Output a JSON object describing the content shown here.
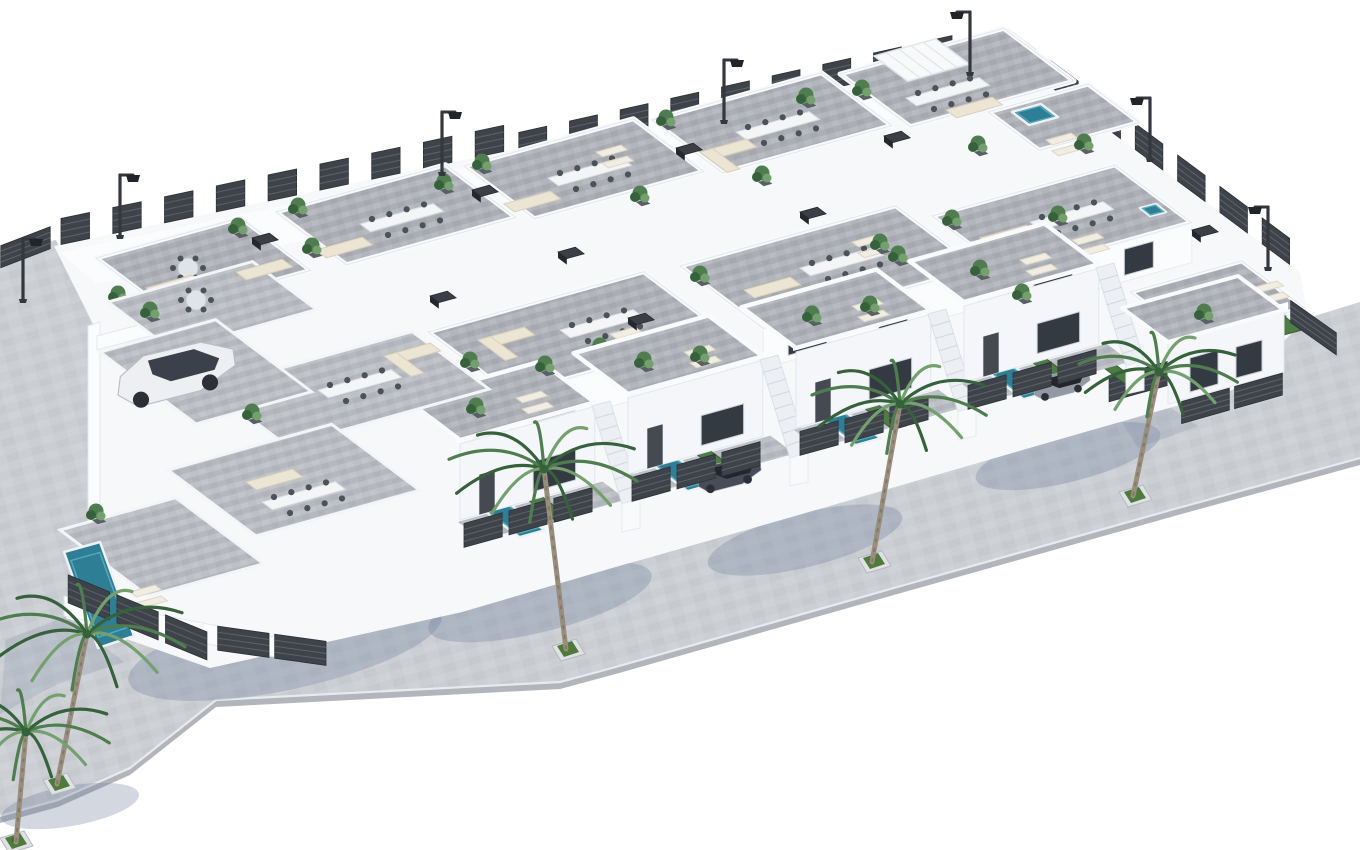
{
  "meta": {
    "title": "New-build villa development - aerial 3D architectural render",
    "description": "Isometric aerial 3D rendering of a gated complex of white modern villas with grey stone roof terraces furnished with outdoor sofas, dining tables and sun loungers, private turquoise plunge pools, dark slatted privacy fencing, perimeter street lamps, parked cars, and a light grey sidewalk lined with palm trees in square planters, on a plain white background.",
    "style": "3D architectural visualization, dimetric aerial view",
    "background": "#ffffff",
    "counts": {
      "villas": 16,
      "roof_terraces": 11,
      "pools": 8,
      "palm_trees": 5,
      "street_lamps": 7,
      "cars": 3,
      "fence_runs": 10
    }
  },
  "palette": {
    "street": "#cbced3",
    "streetFace": "#b2b5bb",
    "curb": "#e8eaed",
    "tile": "#aeb1b7",
    "yard": "#b8bbc1",
    "white": "#fbfcfe",
    "whiteShade": "#eef1f6",
    "whiteDark": "#dde3ea",
    "fence": "#3e434a",
    "fenceLine": "#5a6068",
    "pool": "#2e7e95",
    "poolLight": "#57aabf",
    "green": "#4e7c46",
    "greenDark": "#3a5e33",
    "palm": "#4f7d4f",
    "palmDark": "#35613b",
    "palmLight": "#74a06e",
    "trunk": "#998d7e",
    "cream": "#ece5d4",
    "creamEdge": "#d9d0bb",
    "glass": "#343a42",
    "darkBox": "#3c4046",
    "shadow": "rgba(115,130,160,0.32)",
    "wallShadow": "rgba(125,140,168,0.22)",
    "carWhite": "#edeff3",
    "carDark": "#474d58",
    "carGray": "#9299a3"
  },
  "street": {
    "outline": [
      [
        0,
        250
      ],
      [
        56,
        240
      ],
      [
        97,
        332
      ],
      [
        97,
        552
      ],
      [
        66,
        618
      ],
      [
        210,
        668
      ],
      [
        300,
        648
      ],
      [
        462,
        612
      ],
      [
        612,
        568
      ],
      [
        788,
        518
      ],
      [
        936,
        475
      ],
      [
        1085,
        432
      ],
      [
        1232,
        390
      ],
      [
        1308,
        318
      ],
      [
        1360,
        302
      ],
      [
        1360,
        458
      ],
      [
        1178,
        508
      ],
      [
        908,
        584
      ],
      [
        612,
        668
      ],
      [
        560,
        682
      ],
      [
        216,
        700
      ],
      [
        130,
        768
      ],
      [
        58,
        800
      ],
      [
        0,
        816
      ]
    ],
    "outer": [
      [
        0,
        816
      ],
      [
        58,
        800
      ],
      [
        130,
        768
      ],
      [
        216,
        700
      ],
      [
        560,
        682
      ],
      [
        612,
        668
      ],
      [
        908,
        584
      ],
      [
        1178,
        508
      ],
      [
        1360,
        458
      ]
    ],
    "planters": [
      [
        57,
        782
      ],
      [
        566,
        648
      ],
      [
        872,
        560
      ],
      [
        1133,
        494
      ],
      [
        14,
        840
      ]
    ]
  },
  "parcel": [
    [
      54,
      246
    ],
    [
      520,
      148
    ],
    [
      512,
      160
    ],
    [
      968,
      58
    ],
    [
      1004,
      52
    ],
    [
      1300,
      272
    ],
    [
      1308,
      318
    ],
    [
      1232,
      390
    ],
    [
      1085,
      432
    ],
    [
      936,
      475
    ],
    [
      788,
      518
    ],
    [
      612,
      568
    ],
    [
      462,
      612
    ],
    [
      300,
      648
    ],
    [
      210,
      668
    ],
    [
      66,
      618
    ],
    [
      97,
      552
    ],
    [
      97,
      332
    ]
  ],
  "shadows": {
    "palms": [
      {
        "cx": 285,
        "cy": 648,
        "rx": 160,
        "ry": 42,
        "rot": -12
      },
      {
        "cx": 540,
        "cy": 602,
        "rx": 115,
        "ry": 30,
        "rot": -14
      },
      {
        "cx": 805,
        "cy": 540,
        "rx": 100,
        "ry": 27,
        "rot": -14
      },
      {
        "cx": 1068,
        "cy": 456,
        "rx": 95,
        "ry": 26,
        "rot": -14
      },
      {
        "cx": 70,
        "cy": 806,
        "rx": 70,
        "ry": 20,
        "rot": -10
      }
    ],
    "walls": [
      [
        [
          66,
          616
        ],
        [
          6,
          640
        ],
        [
          0,
          714
        ],
        [
          58,
          684
        ],
        [
          124,
          662
        ]
      ],
      [
        [
          458,
          524
        ],
        [
          410,
          540
        ],
        [
          426,
          566
        ],
        [
          478,
          548
        ]
      ],
      [
        [
          626,
          478
        ],
        [
          578,
          494
        ],
        [
          594,
          520
        ],
        [
          646,
          502
        ]
      ],
      [
        [
          794,
          432
        ],
        [
          746,
          448
        ],
        [
          762,
          474
        ],
        [
          814,
          456
        ]
      ],
      [
        [
          962,
          386
        ],
        [
          914,
          402
        ],
        [
          930,
          428
        ],
        [
          982,
          410
        ]
      ],
      [
        [
          1168,
          406
        ],
        [
          1122,
          422
        ],
        [
          1138,
          448
        ],
        [
          1198,
          426
        ]
      ]
    ]
  },
  "fences": [
    [
      54,
      246,
      520,
      148,
      26
    ],
    [
      512,
      160,
      968,
      58,
      26
    ],
    [
      1004,
      52,
      1300,
      272,
      26
    ],
    [
      0,
      268,
      52,
      248,
      22
    ],
    [
      1108,
      402,
      1180,
      382,
      24
    ]
  ],
  "back_terraces": [
    {
      "x": 96,
      "y": 258,
      "w": 150,
      "d": 88,
      "furn": [
        [
          "round",
          188,
          268
        ],
        [
          "sofa",
          146,
          288
        ],
        [
          "plant",
          118,
          302
        ],
        [
          "plant",
          238,
          234
        ]
      ]
    },
    {
      "x": 276,
      "y": 212,
      "w": 176,
      "d": 88,
      "furn": [
        [
          "table",
          360,
          224
        ],
        [
          "sofa",
          316,
          250
        ],
        [
          "plant",
          298,
          214
        ],
        [
          "plant",
          444,
          190
        ]
      ]
    },
    {
      "x": 464,
      "y": 166,
      "w": 176,
      "d": 88,
      "furn": [
        [
          "table",
          548,
          178
        ],
        [
          "sofa",
          504,
          204
        ],
        [
          "lounge",
          596,
          152
        ],
        [
          "plant",
          482,
          170
        ]
      ]
    },
    {
      "x": 652,
      "y": 120,
      "w": 176,
      "d": 88,
      "furn": [
        [
          "table",
          736,
          132
        ],
        [
          "sofaL",
          700,
          152
        ],
        [
          "plant",
          666,
          126
        ],
        [
          "plant",
          806,
          104
        ]
      ]
    },
    {
      "x": 840,
      "y": 74,
      "w": 170,
      "d": 88,
      "furn": [
        [
          "pergola",
          874,
          56
        ],
        [
          "table",
          906,
          98
        ],
        [
          "sofa",
          946,
          110
        ],
        [
          "plant",
          862,
          96
        ]
      ]
    },
    {
      "x": 988,
      "y": 112,
      "w": 104,
      "d": 64,
      "furn": [
        [
          "lounge",
          1046,
          140
        ],
        [
          "plant",
          1084,
          150
        ]
      ]
    }
  ],
  "mid_terraces": [
    {
      "x": 428,
      "y": 332,
      "w": 224,
      "d": 104,
      "facade": 1,
      "furn": [
        [
          "table",
          560,
          330
        ],
        [
          "sofaL",
          478,
          340
        ],
        [
          "lounge",
          610,
          334
        ],
        [
          "plant",
          600,
          354
        ],
        [
          "plant",
          470,
          368
        ]
      ]
    },
    {
      "x": 680,
      "y": 266,
      "w": 224,
      "d": 104,
      "facade": 1,
      "furn": [
        [
          "table",
          800,
          268
        ],
        [
          "sofa",
          744,
          290
        ],
        [
          "lounge",
          852,
          242
        ],
        [
          "plant",
          700,
          282
        ],
        [
          "plant",
          880,
          250
        ]
      ]
    },
    {
      "x": 932,
      "y": 216,
      "w": 190,
      "d": 96,
      "facade": 1,
      "furn": [
        [
          "table",
          1030,
          222
        ],
        [
          "sofaL",
          980,
          238
        ],
        [
          "plant",
          952,
          226
        ],
        [
          "lounge",
          1072,
          240
        ]
      ]
    },
    {
      "x": 1130,
      "y": 292,
      "w": 116,
      "d": 78,
      "furn": [
        [
          "sofa",
          1180,
          300
        ],
        [
          "round",
          1226,
          306
        ],
        [
          "plant",
          1160,
          316
        ],
        [
          "lounge",
          1252,
          288
        ]
      ]
    }
  ],
  "front_houses": [
    {
      "x": 460,
      "y": 520
    },
    {
      "x": 628,
      "y": 474,
      "car": "dark"
    },
    {
      "x": 796,
      "y": 428
    },
    {
      "x": 964,
      "y": 382,
      "car": "gray"
    }
  ],
  "left_block": {
    "walls": [
      [
        [
          88,
          326
        ],
        [
          100,
          322
        ],
        [
          100,
          568
        ],
        [
          88,
          574
        ]
      ],
      [
        [
          97,
          336
        ],
        [
          282,
          287
        ],
        [
          282,
          301
        ],
        [
          97,
          350
        ]
      ],
      [
        [
          64,
          596
        ],
        [
          300,
          642
        ],
        [
          300,
          662
        ],
        [
          64,
          616
        ]
      ]
    ],
    "tiles": [
      [
        108,
        302,
        150,
        80
      ],
      [
        210,
        388,
        210,
        96
      ],
      [
        168,
        470,
        170,
        110
      ],
      [
        100,
        352,
        120,
        120
      ],
      [
        60,
        530,
        120,
        110
      ]
    ],
    "pool": [
      [
        64,
        552
      ],
      [
        100,
        542
      ],
      [
        134,
        636
      ],
      [
        98,
        648
      ]
    ],
    "furniture": [
      [
        "round",
        196,
        300
      ],
      [
        "sofa",
        236,
        272
      ],
      [
        "plant",
        150,
        318
      ],
      [
        "table",
        318,
        390
      ],
      [
        "plant",
        252,
        420
      ],
      [
        "sofaL",
        384,
        356
      ],
      [
        "sofa",
        246,
        482
      ],
      [
        "table",
        262,
        502
      ],
      [
        "lounge",
        130,
        592
      ],
      [
        "plant",
        96,
        520
      ]
    ],
    "fences": [
      [
        66,
        602,
        212,
        662,
        28
      ],
      [
        216,
        650,
        330,
        666,
        24
      ]
    ],
    "car": {
      "x": 118,
      "y": 402,
      "type": "suv"
    }
  },
  "corner_house": {
    "facade": [
      [
        1168,
        404
      ],
      [
        1284,
        372
      ],
      [
        1284,
        310
      ],
      [
        1168,
        342
      ]
    ],
    "slab": [
      [
        1164,
        344
      ],
      [
        1288,
        310
      ],
      [
        1288,
        302
      ],
      [
        1164,
        336
      ]
    ],
    "roof": [
      [
        1168,
        342
      ],
      [
        1284,
        310
      ],
      [
        1238,
        276
      ],
      [
        1122,
        308
      ]
    ],
    "windows": [
      [
        [
          1190,
          392
        ],
        [
          1218,
          384
        ],
        [
          1218,
          350
        ],
        [
          1190,
          358
        ]
      ],
      [
        [
          1236,
          378
        ],
        [
          1262,
          371
        ],
        [
          1262,
          340
        ],
        [
          1236,
          347
        ]
      ]
    ],
    "pool": [
      [
        1236,
        300
      ],
      [
        1259,
        294
      ],
      [
        1290,
        317
      ],
      [
        1267,
        323
      ]
    ],
    "hedge": [
      [
        1262,
        322
      ],
      [
        1284,
        316
      ],
      [
        1302,
        330
      ],
      [
        1280,
        336
      ]
    ],
    "fences": [
      [
        1290,
        322,
        1338,
        356,
        22
      ],
      [
        1180,
        424,
        1286,
        394,
        22
      ]
    ]
  },
  "pools_extra": [
    {
      "pts": [
        [
          1012,
          112
        ],
        [
          1041,
          104
        ],
        [
          1058,
          117
        ],
        [
          1029,
          125
        ]
      ],
      "name": "rooftop-pool"
    },
    {
      "pts": [
        [
          1140,
          208
        ],
        [
          1156,
          204
        ],
        [
          1166,
          212
        ],
        [
          1150,
          216
        ]
      ],
      "name": "spa-pool"
    }
  ],
  "hedges_extra": [
    {
      "x": 1096,
      "y": 362,
      "w": 12,
      "d": 36
    }
  ],
  "plants_extra": [
    [
      312,
      254
    ],
    [
      640,
      202
    ],
    [
      762,
      182
    ],
    [
      978,
      152
    ],
    [
      1058,
      222
    ],
    [
      898,
      262
    ],
    [
      1204,
      320
    ],
    [
      700,
      362
    ],
    [
      870,
      312
    ],
    [
      1022,
      300
    ],
    [
      545,
      372
    ]
  ],
  "ac_units": [
    [
      800,
      212
    ],
    [
      884,
      136
    ],
    [
      558,
      252
    ],
    [
      430,
      296
    ],
    [
      252,
      238
    ],
    [
      1192,
      230
    ],
    [
      676,
      148
    ],
    [
      472,
      190
    ],
    [
      628,
      318
    ]
  ],
  "palms": [
    {
      "x": 57,
      "y": 784,
      "h": 150,
      "lean": 30,
      "s": 100
    },
    {
      "x": 566,
      "y": 649,
      "h": 180,
      "lean": -22,
      "s": 95
    },
    {
      "x": 872,
      "y": 562,
      "h": 158,
      "lean": 28,
      "s": 88
    },
    {
      "x": 1133,
      "y": 496,
      "h": 124,
      "lean": 26,
      "s": 80
    },
    {
      "x": 16,
      "y": 842,
      "h": 110,
      "lean": 10,
      "s": 85
    }
  ],
  "lamps": [
    {
      "x": 23,
      "y": 299,
      "d": 1
    },
    {
      "x": 120,
      "y": 235,
      "d": 1
    },
    {
      "x": 442,
      "y": 172,
      "d": 1
    },
    {
      "x": 724,
      "y": 120,
      "d": 1
    },
    {
      "x": 970,
      "y": 72,
      "d": -1
    },
    {
      "x": 1150,
      "y": 158,
      "d": -1
    },
    {
      "x": 1268,
      "y": 267,
      "d": -1
    }
  ]
}
